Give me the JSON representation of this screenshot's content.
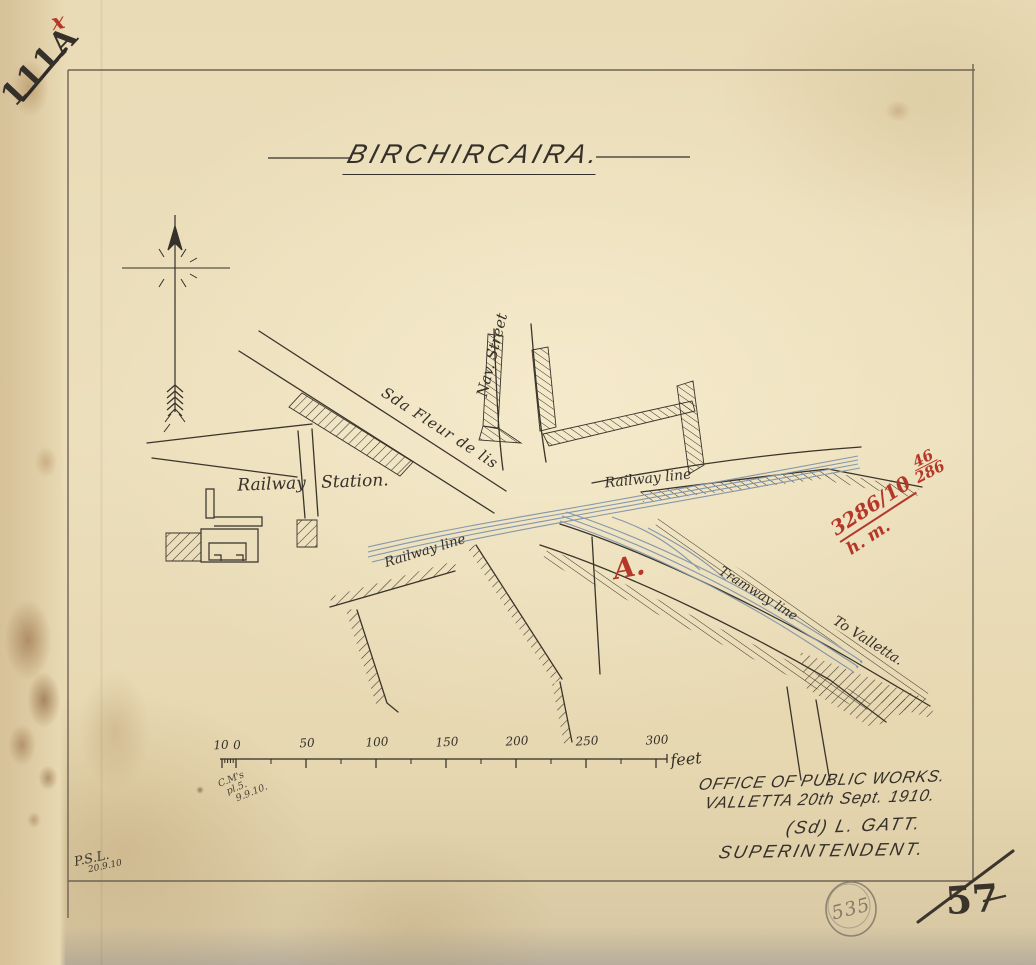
{
  "archive": {
    "number": "111A",
    "red_mark": "x"
  },
  "title": "BIRCHIRCAIRA.",
  "map_labels": {
    "nav_street": "Nav. Street",
    "fleur_de_lis": "Sda Fleur de lis",
    "railway_station": "Railway Station.",
    "railway_line_upper": "Railway line",
    "railway_line_lower": "Railway line",
    "tramway_line": "Tramway line",
    "to_valletta": "To Valletta.",
    "point_a": "A."
  },
  "red_note": {
    "reference": "3286/10",
    "fraction_top": "46",
    "fraction_bottom": "286",
    "initials": "h. m."
  },
  "scale_bar": {
    "tick_labels": [
      "10",
      "0",
      "50",
      "100",
      "150",
      "200",
      "250",
      "300"
    ],
    "unit": "feet"
  },
  "pencil_notes": {
    "near_scale_line1": "C.M's",
    "near_scale_line2": "pl.5.",
    "near_scale_line3": "9.9.10.",
    "bottom_left_line1": "P.S.L.",
    "bottom_left_line2": "20.9.10"
  },
  "signature_block": {
    "line1": "OFFICE OF PUBLIC WORKS.",
    "line2": "VALLETTA 20th Sept. 1910.",
    "line3": "(Sd) L. GATT.",
    "line4": "SUPERINTENDENT."
  },
  "stamps": {
    "circled_number": "535",
    "corner_number": "57"
  },
  "colors": {
    "paper": "#e8dab4",
    "ink": "#35302a",
    "railway_blue": "#8497ab",
    "annotation_red": "#b5372a",
    "pencil": "#6f675c"
  }
}
